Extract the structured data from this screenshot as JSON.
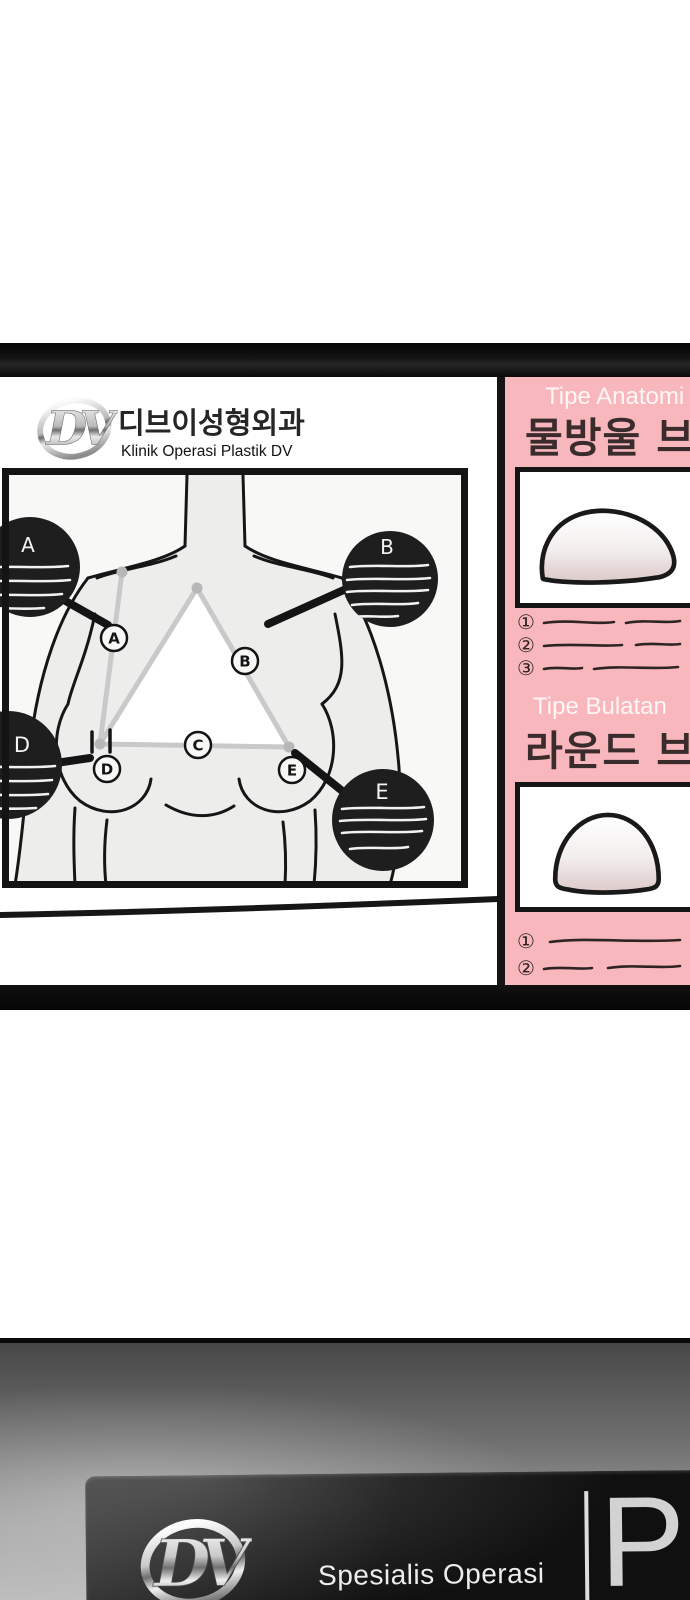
{
  "colors": {
    "panel_pink": "#f8b7bc",
    "frame_black": "#0d0d0d",
    "section_title_white": "#fff6f5",
    "korean_heading_dark": "#3a2c2d"
  },
  "board": {
    "clinic": {
      "logo_monogram": "DV",
      "korean_name": "디브이성형외과",
      "latin_name": "Klinik Operasi Plastik DV"
    },
    "diagram": {
      "callouts": [
        {
          "letter": "A"
        },
        {
          "letter": "B"
        },
        {
          "letter": "D"
        },
        {
          "letter": "E"
        }
      ],
      "point_labels": [
        "A",
        "B",
        "C",
        "D",
        "E"
      ]
    },
    "panel": {
      "sections": [
        {
          "title": "Tipe Anatomi",
          "korean": "물방울 브",
          "list_markers": [
            "①",
            "②",
            "③"
          ]
        },
        {
          "title": "Tipe Bulatan",
          "korean": "라운드 브",
          "list_markers": [
            "①",
            "②"
          ]
        }
      ]
    }
  },
  "banner": {
    "logo_monogram": "DV",
    "caption": "Spesialis Operasi",
    "partial_letter": "P"
  }
}
